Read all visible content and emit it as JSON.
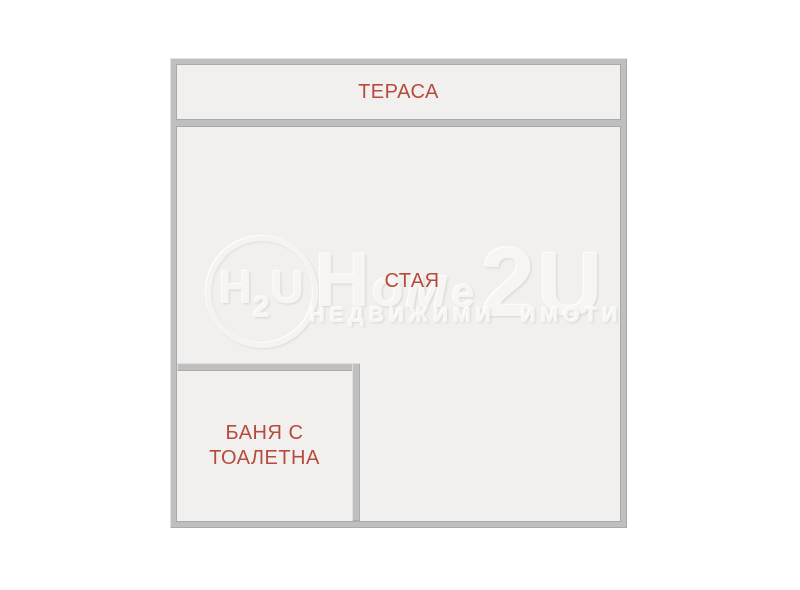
{
  "plan": {
    "rooms": {
      "terrace": {
        "label": "ТЕРАСА"
      },
      "living": {
        "label": "СТАЯ"
      },
      "bathroom": {
        "line1": "БАНЯ С",
        "line2": "ТОАЛЕТНА"
      }
    },
    "colors": {
      "wall": "#bfbfbf",
      "floor": "#f1f0ee",
      "room_label": "#b64b3d"
    }
  },
  "watermark": {
    "logo": {
      "letters": {
        "l1": "H",
        "l2": "2",
        "l3": "U"
      }
    },
    "brand": {
      "letters": {
        "l1": "H",
        "l2": "o",
        "l3": "м",
        "l4": "е",
        "l5": "2",
        "l6": "U"
      }
    },
    "subtitle": "НЕДВИЖИМИ ИМОТИ"
  }
}
